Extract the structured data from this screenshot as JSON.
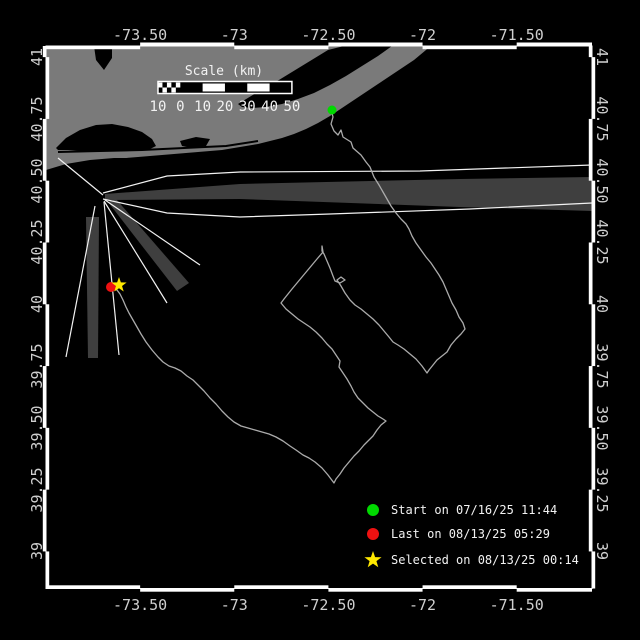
{
  "figure": {
    "width": 640,
    "height": 640,
    "background": "#000000"
  },
  "map": {
    "extent": {
      "lon_min": -74.0,
      "lon_max": -71.1,
      "lat_min": 38.85,
      "lat_max": 41.045
    },
    "axes": {
      "x_tick_labels": [
        "-73.50",
        "-73",
        "-72.50",
        "-72",
        "-71.50"
      ],
      "x_tick_lons": [
        -73.5,
        -73.0,
        -72.5,
        -72.0,
        -71.5
      ],
      "y_tick_labels": [
        "41",
        "40.75",
        "40.50",
        "40.25",
        "40",
        "39.75",
        "39.50",
        "39.25",
        "39"
      ],
      "y_tick_lats": [
        41.0,
        40.75,
        40.5,
        40.25,
        40.0,
        39.75,
        39.5,
        39.25,
        39.0
      ],
      "tick_text_color": "#cfcfcf",
      "border_color": "#ffffff"
    },
    "scalebar": {
      "title": "Scale (km)",
      "labels": [
        "10",
        "0",
        "10",
        "20",
        "30",
        "40",
        "50"
      ],
      "km_values": [
        -10,
        0,
        10,
        20,
        30,
        40,
        50
      ]
    },
    "legend": {
      "entries": [
        {
          "marker": "circle",
          "color": "#00d900",
          "label": "Start on 07/16/25 11:44"
        },
        {
          "marker": "circle",
          "color": "#ee1111",
          "label": "Last on 08/13/25 05:29"
        },
        {
          "marker": "star",
          "color": "#ffe800",
          "label": "Selected on 08/13/25 00:14"
        }
      ]
    },
    "markers": {
      "start": {
        "x": 332,
        "y": 110,
        "color": "#00d900",
        "shape": "circle"
      },
      "last": {
        "x": 111,
        "y": 287,
        "color": "#ee1111",
        "shape": "circle"
      },
      "selected": {
        "x": 119,
        "y": 285,
        "color": "#ffe800",
        "shape": "star"
      }
    },
    "track": {
      "color": "#ababab",
      "points": [
        [
          331,
          109
        ],
        [
          333,
          117
        ],
        [
          331,
          124
        ],
        [
          334,
          131
        ],
        [
          338,
          135
        ],
        [
          341,
          130
        ],
        [
          343,
          137
        ],
        [
          351,
          142
        ],
        [
          353,
          148
        ],
        [
          361,
          155
        ],
        [
          366,
          162
        ],
        [
          370,
          167
        ],
        [
          374,
          177
        ],
        [
          379,
          185
        ],
        [
          383,
          192
        ],
        [
          387,
          199
        ],
        [
          391,
          206
        ],
        [
          396,
          213
        ],
        [
          401,
          219
        ],
        [
          406,
          224
        ],
        [
          409,
          229
        ],
        [
          412,
          236
        ],
        [
          416,
          243
        ],
        [
          421,
          250
        ],
        [
          426,
          257
        ],
        [
          431,
          263
        ],
        [
          435,
          269
        ],
        [
          439,
          275
        ],
        [
          443,
          282
        ],
        [
          446,
          289
        ],
        [
          449,
          296
        ],
        [
          452,
          303
        ],
        [
          456,
          310
        ],
        [
          459,
          317
        ],
        [
          463,
          323
        ],
        [
          465,
          329
        ],
        [
          461,
          334
        ],
        [
          456,
          339
        ],
        [
          451,
          345
        ],
        [
          447,
          352
        ],
        [
          442,
          356
        ],
        [
          437,
          360
        ],
        [
          433,
          365
        ],
        [
          429,
          370
        ],
        [
          427,
          373
        ],
        [
          422,
          366
        ],
        [
          416,
          359
        ],
        [
          410,
          354
        ],
        [
          404,
          349
        ],
        [
          398,
          345
        ],
        [
          393,
          342
        ],
        [
          389,
          337
        ],
        [
          384,
          331
        ],
        [
          379,
          325
        ],
        [
          373,
          319
        ],
        [
          367,
          314
        ],
        [
          361,
          309
        ],
        [
          355,
          305
        ],
        [
          350,
          300
        ],
        [
          345,
          293
        ],
        [
          341,
          286
        ],
        [
          337,
          280
        ],
        [
          341,
          277
        ],
        [
          345,
          280
        ],
        [
          340,
          283
        ],
        [
          335,
          281
        ],
        [
          333,
          276
        ],
        [
          330,
          268
        ],
        [
          327,
          261
        ],
        [
          324,
          254
        ],
        [
          322,
          251
        ],
        [
          322,
          246
        ],
        [
          323,
          252
        ],
        [
          317,
          259
        ],
        [
          312,
          265
        ],
        [
          307,
          271
        ],
        [
          302,
          277
        ],
        [
          297,
          283
        ],
        [
          292,
          289
        ],
        [
          288,
          294
        ],
        [
          284,
          299
        ],
        [
          281,
          303
        ],
        [
          286,
          309
        ],
        [
          292,
          314
        ],
        [
          298,
          319
        ],
        [
          304,
          323
        ],
        [
          310,
          327
        ],
        [
          316,
          332
        ],
        [
          322,
          338
        ],
        [
          327,
          344
        ],
        [
          332,
          349
        ],
        [
          336,
          355
        ],
        [
          340,
          361
        ],
        [
          339,
          367
        ],
        [
          343,
          373
        ],
        [
          347,
          379
        ],
        [
          351,
          386
        ],
        [
          354,
          392
        ],
        [
          358,
          398
        ],
        [
          363,
          403
        ],
        [
          368,
          408
        ],
        [
          373,
          412
        ],
        [
          378,
          416
        ],
        [
          383,
          419
        ],
        [
          386,
          421
        ],
        [
          381,
          425
        ],
        [
          377,
          430
        ],
        [
          373,
          436
        ],
        [
          368,
          441
        ],
        [
          364,
          445
        ],
        [
          359,
          451
        ],
        [
          354,
          456
        ],
        [
          349,
          462
        ],
        [
          344,
          468
        ],
        [
          340,
          474
        ],
        [
          336,
          479
        ],
        [
          334,
          483
        ],
        [
          328,
          475
        ],
        [
          322,
          468
        ],
        [
          315,
          462
        ],
        [
          309,
          458
        ],
        [
          303,
          455
        ],
        [
          296,
          450
        ],
        [
          290,
          446
        ],
        [
          283,
          441
        ],
        [
          276,
          437
        ],
        [
          269,
          434
        ],
        [
          262,
          432
        ],
        [
          255,
          430
        ],
        [
          248,
          428
        ],
        [
          241,
          426
        ],
        [
          234,
          422
        ],
        [
          228,
          417
        ],
        [
          222,
          411
        ],
        [
          216,
          404
        ],
        [
          210,
          398
        ],
        [
          204,
          391
        ],
        [
          198,
          385
        ],
        [
          193,
          380
        ],
        [
          187,
          376
        ],
        [
          181,
          371
        ],
        [
          175,
          368
        ],
        [
          169,
          366
        ],
        [
          163,
          362
        ],
        [
          158,
          357
        ],
        [
          152,
          350
        ],
        [
          146,
          342
        ],
        [
          141,
          334
        ],
        [
          137,
          327
        ],
        [
          133,
          320
        ],
        [
          129,
          313
        ],
        [
          126,
          307
        ],
        [
          123,
          300
        ],
        [
          120,
          294
        ],
        [
          117,
          290
        ],
        [
          113,
          288
        ],
        [
          111,
          287
        ]
      ]
    },
    "land": {
      "color": "#7a7a7a",
      "outline": [
        [
          46,
          46
        ],
        [
          430,
          46
        ],
        [
          426,
          50
        ],
        [
          414,
          60
        ],
        [
          402,
          68
        ],
        [
          390,
          76
        ],
        [
          378,
          84
        ],
        [
          366,
          92
        ],
        [
          354,
          100
        ],
        [
          342,
          108
        ],
        [
          330,
          116
        ],
        [
          318,
          123
        ],
        [
          306,
          129
        ],
        [
          294,
          134
        ],
        [
          282,
          138
        ],
        [
          270,
          141
        ],
        [
          258,
          144
        ],
        [
          246,
          146
        ],
        [
          234,
          148
        ],
        [
          222,
          150
        ],
        [
          210,
          151
        ],
        [
          198,
          152
        ],
        [
          186,
          153
        ],
        [
          174,
          154
        ],
        [
          162,
          155
        ],
        [
          150,
          156
        ],
        [
          138,
          157
        ],
        [
          126,
          158
        ],
        [
          114,
          158
        ],
        [
          102,
          159
        ],
        [
          90,
          160
        ],
        [
          78,
          162
        ],
        [
          66,
          164
        ],
        [
          56,
          167
        ],
        [
          46,
          170
        ]
      ],
      "bays": [
        [
          [
            238,
            104
          ],
          [
            256,
            93
          ],
          [
            274,
            83
          ],
          [
            292,
            72
          ],
          [
            310,
            61
          ],
          [
            328,
            50
          ],
          [
            344,
            46
          ],
          [
            392,
            46
          ],
          [
            378,
            56
          ],
          [
            362,
            66
          ],
          [
            346,
            76
          ],
          [
            330,
            85
          ],
          [
            314,
            93
          ],
          [
            298,
            99
          ],
          [
            282,
            104
          ],
          [
            266,
            107
          ],
          [
            252,
            108
          ],
          [
            242,
            107
          ]
        ],
        [
          [
            56,
            148
          ],
          [
            66,
            138
          ],
          [
            80,
            130
          ],
          [
            96,
            125
          ],
          [
            112,
            124
          ],
          [
            128,
            127
          ],
          [
            142,
            132
          ],
          [
            152,
            139
          ],
          [
            156,
            146
          ],
          [
            148,
            150
          ],
          [
            132,
            151
          ],
          [
            116,
            151
          ],
          [
            100,
            151
          ],
          [
            84,
            151
          ],
          [
            68,
            150
          ],
          [
            58,
            150
          ]
        ],
        [
          [
            94,
            46
          ],
          [
            112,
            46
          ],
          [
            112,
            58
          ],
          [
            104,
            70
          ],
          [
            96,
            60
          ]
        ],
        [
          [
            180,
            141
          ],
          [
            196,
            137
          ],
          [
            210,
            139
          ],
          [
            206,
            146
          ],
          [
            192,
            148
          ],
          [
            182,
            146
          ]
        ]
      ],
      "lagoon": [
        [
          58,
          152
        ],
        [
          100,
          151
        ],
        [
          142,
          150
        ],
        [
          184,
          148
        ],
        [
          226,
          146
        ],
        [
          258,
          141
        ]
      ]
    },
    "lanes": {
      "fill": "#3f3f3f",
      "line_color": "#f2f2f2",
      "wedges": [
        [
          [
            105,
            194
          ],
          [
            240,
            184
          ],
          [
            460,
            179
          ],
          [
            592,
            177
          ],
          [
            592,
            211
          ],
          [
            460,
            207
          ],
          [
            240,
            199
          ],
          [
            105,
            200
          ]
        ],
        [
          [
            108,
            202
          ],
          [
            116,
            199
          ],
          [
            189,
            283
          ],
          [
            177,
            291
          ]
        ],
        [
          [
            86,
            217
          ],
          [
            99,
            217
          ],
          [
            98,
            358
          ],
          [
            88,
            358
          ]
        ]
      ],
      "lines": [
        [
          [
            58,
            158
          ],
          [
            103,
            195
          ]
        ],
        [
          [
            103,
            193
          ],
          [
            167,
            176
          ],
          [
            240,
            172
          ],
          [
            420,
            171
          ],
          [
            592,
            165
          ]
        ],
        [
          [
            103,
            199
          ],
          [
            167,
            213
          ],
          [
            240,
            217
          ],
          [
            330,
            214
          ],
          [
            470,
            209
          ],
          [
            592,
            203
          ]
        ],
        [
          [
            105,
            200
          ],
          [
            200,
            265
          ]
        ],
        [
          [
            104,
            201
          ],
          [
            167,
            303
          ]
        ],
        [
          [
            104,
            202
          ],
          [
            119,
            355
          ]
        ],
        [
          [
            95,
            206
          ],
          [
            66,
            357
          ]
        ]
      ]
    }
  }
}
